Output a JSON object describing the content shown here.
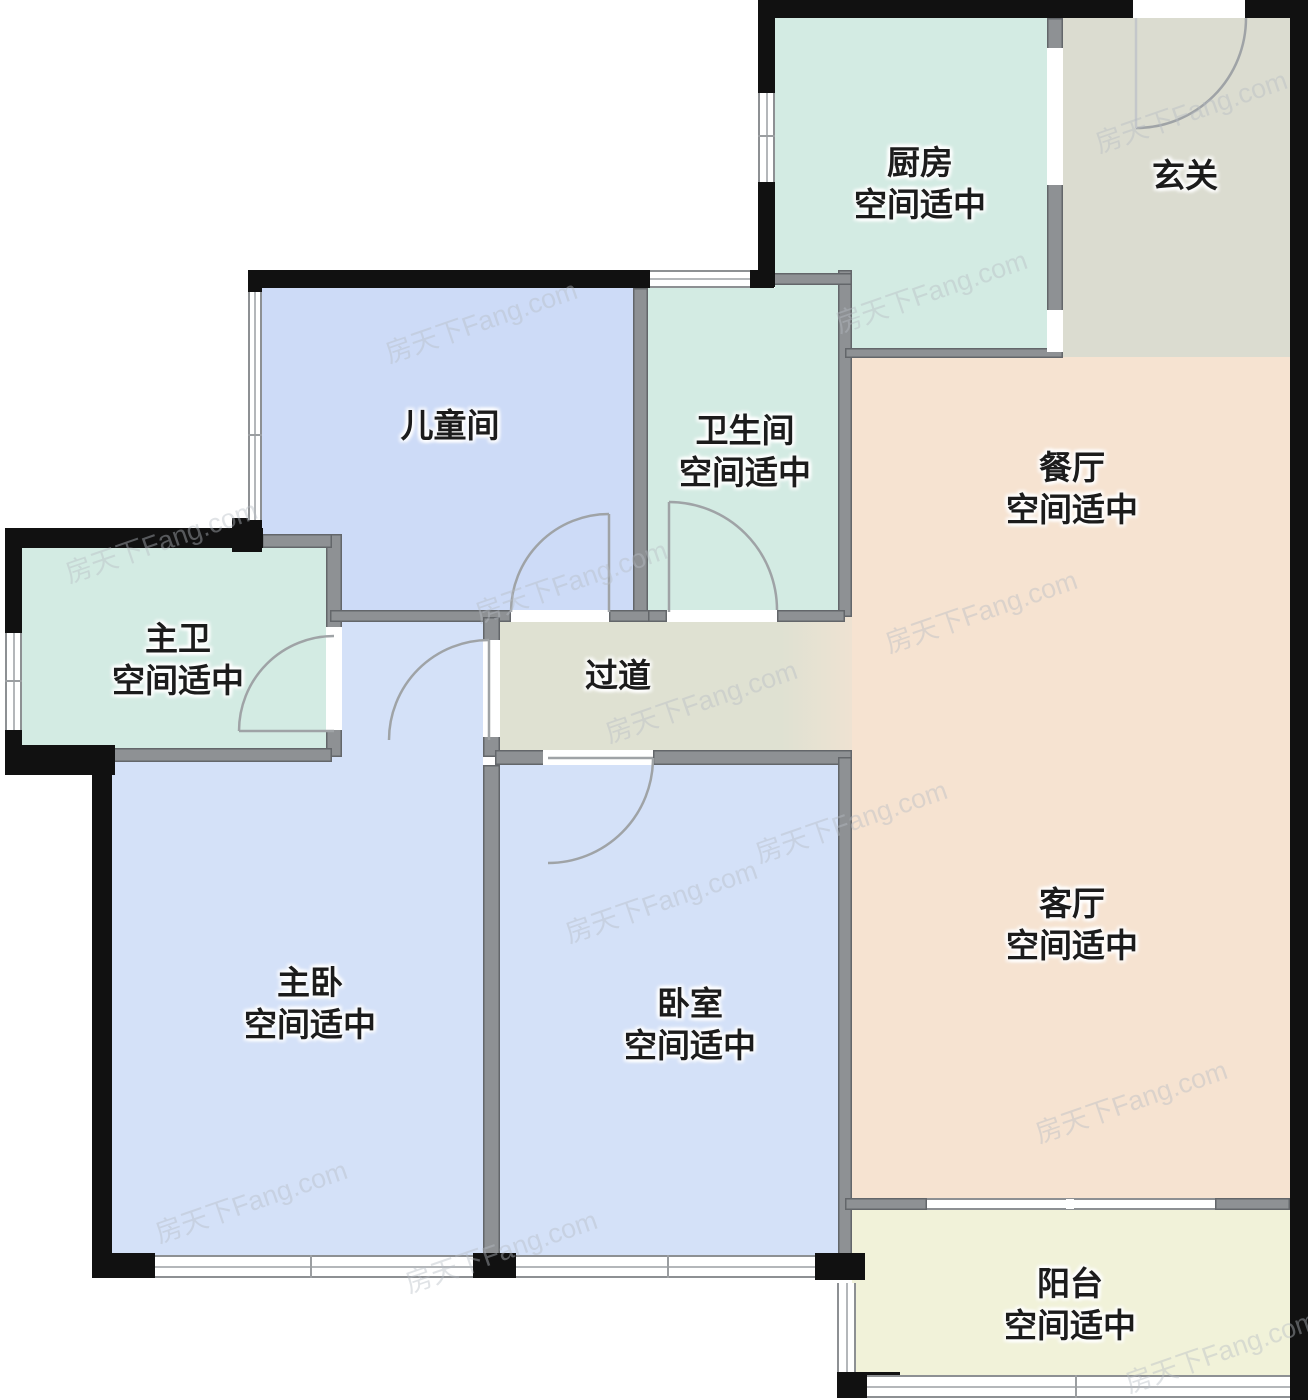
{
  "watermark": "房天下Fang.com",
  "rooms": {
    "kitchen": {
      "name": "厨房",
      "note": "空间适中"
    },
    "foyer": {
      "name": "玄关",
      "note": ""
    },
    "kids_room": {
      "name": "儿童间",
      "note": ""
    },
    "bathroom": {
      "name": "卫生间",
      "note": "空间适中"
    },
    "dining": {
      "name": "餐厅",
      "note": "空间适中"
    },
    "master_bath": {
      "name": "主卫",
      "note": "空间适中"
    },
    "hallway": {
      "name": "过道",
      "note": ""
    },
    "master_bedroom": {
      "name": "主卧",
      "note": "空间适中"
    },
    "bedroom": {
      "name": "卧室",
      "note": "空间适中"
    },
    "living": {
      "name": "客厅",
      "note": "空间适中"
    },
    "balcony": {
      "name": "阳台",
      "note": "空间适中"
    }
  },
  "palette": {
    "exterior_wall": "#111111",
    "interior_wall": "#8e9194",
    "kitchen_bath_fill": "#d3ebe3",
    "bedroom_fill": "#d4e1f8",
    "dining_living_fill": "#f6e3d1",
    "foyer_hallway_fill": "#dbdcd0",
    "balcony_fill": "#f1f2d9",
    "label_color": "#1c1c1c"
  }
}
